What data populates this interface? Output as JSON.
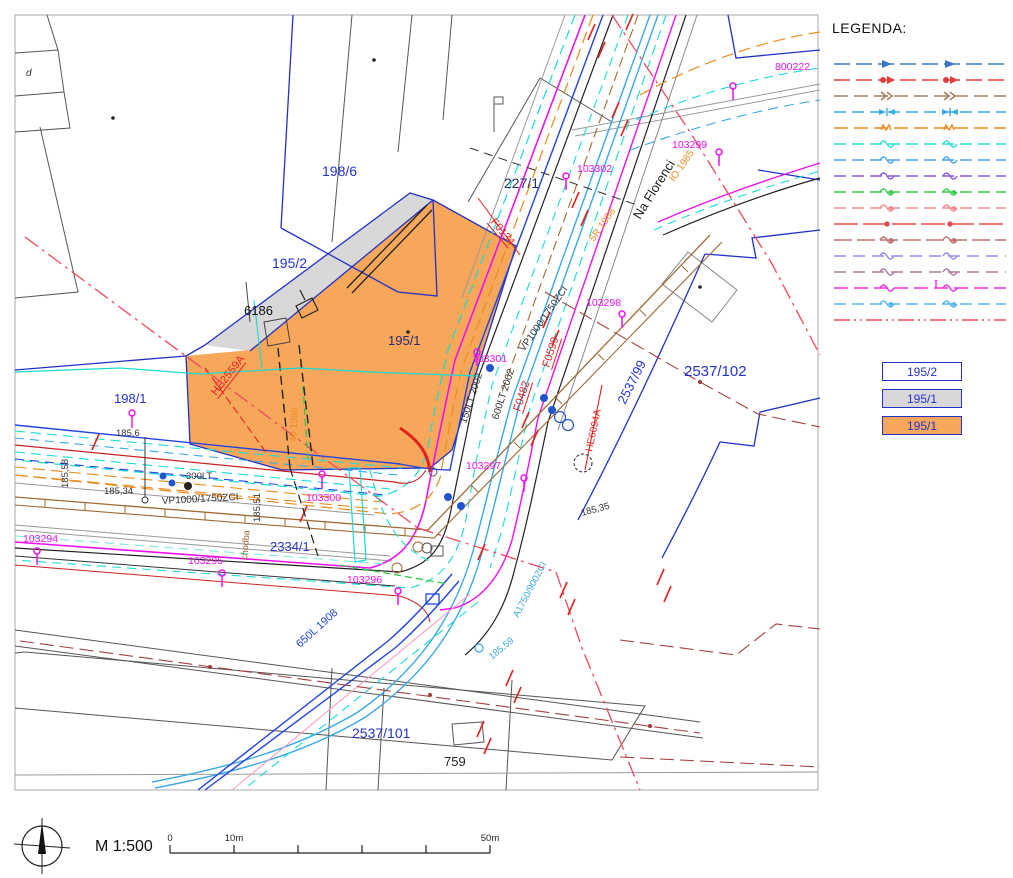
{
  "palette": {
    "parcel_blue": "#2230c8",
    "label_blue": "#2233cc",
    "navy": "#223366",
    "magenta": "#ee11ee",
    "red": "#e22222",
    "orange": "#ea8c1e",
    "cyan": "#17dcd4",
    "skyblue": "#39a8e8",
    "cobalt": "#2244dd",
    "brown": "#a06a32",
    "darkred": "#a4403f",
    "green": "#2ecb44",
    "gray": "#8a8a8a",
    "orange_fill": "#f6a75a",
    "gray_fill": "#d8d8d8",
    "dashdot_red": "#f2485c"
  },
  "legend": {
    "title": "LEGENDA:",
    "lines": [
      {
        "color": "#3b76c8",
        "marker": "arrow",
        "dash": "16 6"
      },
      {
        "color": "#e43b3b",
        "marker": "dotarrow",
        "dash": "16 6"
      },
      {
        "color": "#a5805f",
        "marker": "chevrons",
        "dash": "14 6"
      },
      {
        "color": "#35aaea",
        "marker": "bowtie",
        "dash": "12 6"
      },
      {
        "color": "#ea8c1e",
        "marker": "zigzag",
        "dash": "14 6"
      },
      {
        "color": "#2ae0d4",
        "marker": "sine",
        "dash": "12 6"
      },
      {
        "color": "#4aa3f0",
        "marker": "sine",
        "dash": "12 6"
      },
      {
        "color": "#8a5ae0",
        "marker": "sine",
        "dash": "12 6"
      },
      {
        "color": "#3ecb50",
        "marker": "sinedot",
        "dash": "12 6"
      },
      {
        "color": "#ef8d8d",
        "marker": "sinedot",
        "dash": "12 6"
      },
      {
        "color": "#e84848",
        "marker": "dot",
        "dash": "24 5"
      },
      {
        "color": "#bf7272",
        "marker": "sinedot",
        "dash": "18 5"
      },
      {
        "color": "#9a8ce8",
        "marker": "sine",
        "dash": "12 7"
      },
      {
        "color": "#b27a9a",
        "marker": "sine",
        "dash": "12 7"
      },
      {
        "color": "#ee2ee0",
        "marker": "lollipop",
        "dash": "14 6"
      },
      {
        "color": "#57b8ea",
        "marker": "sinedot",
        "dash": "12 6"
      },
      {
        "color": "#f2485c",
        "marker": "none",
        "dash": "16 4 2 4 2 4"
      }
    ],
    "swatches": [
      {
        "label": "195/2",
        "fill": "#ffffff"
      },
      {
        "label": "195/1",
        "fill": "#d8d8d8"
      },
      {
        "label": "195/1",
        "fill": "#f6a75a"
      }
    ]
  },
  "map": {
    "parcel_labels": [
      {
        "text": "d",
        "x": 26,
        "y": 76,
        "color": "#333",
        "size": 10,
        "italic": true
      },
      {
        "text": "198/6",
        "x": 322,
        "y": 176,
        "color": "#2233cc",
        "size": 14
      },
      {
        "text": "227/1",
        "x": 504,
        "y": 188,
        "color": "#223366",
        "size": 14
      },
      {
        "text": "195/2",
        "x": 272,
        "y": 268,
        "color": "#2233cc",
        "size": 14
      },
      {
        "text": "6186",
        "x": 244,
        "y": 315,
        "color": "#111111",
        "size": 13
      },
      {
        "text": "195/1",
        "x": 388,
        "y": 345,
        "color": "#2a2a70",
        "size": 13
      },
      {
        "text": "198/1",
        "x": 114,
        "y": 403,
        "color": "#2233cc",
        "size": 13
      },
      {
        "text": "2334/1",
        "x": 270,
        "y": 551,
        "color": "#2233cc",
        "size": 13
      },
      {
        "text": "2537/102",
        "x": 684,
        "y": 376,
        "color": "#2233cc",
        "size": 15
      },
      {
        "text": "2537/99",
        "x": 625,
        "y": 405,
        "rot": -63,
        "color": "#2233cc",
        "size": 13
      },
      {
        "text": "2537/101",
        "x": 352,
        "y": 738,
        "color": "#2233cc",
        "size": 14
      },
      {
        "text": "759",
        "x": 444,
        "y": 766,
        "color": "#222222",
        "size": 13
      }
    ],
    "point_labels": [
      {
        "text": "800222",
        "x": 775,
        "y": 70,
        "mx": 733,
        "my": 86
      },
      {
        "text": "103299",
        "x": 672,
        "y": 148,
        "mx": 719,
        "my": 152
      },
      {
        "text": "103302",
        "x": 577,
        "y": 172,
        "mx": 566,
        "my": 176
      },
      {
        "text": "103298",
        "x": 586,
        "y": 306,
        "mx": 622,
        "my": 314
      },
      {
        "text": "103301",
        "x": 472,
        "y": 362,
        "mx": 477,
        "my": 352
      },
      {
        "text": "103297",
        "x": 466,
        "y": 469,
        "mx": 524,
        "my": 478
      },
      {
        "text": "103300",
        "x": 306,
        "y": 501,
        "mx": 322,
        "my": 474
      },
      {
        "text": "103294",
        "x": 23,
        "y": 542,
        "mx": 37,
        "my": 551
      },
      {
        "text": "103295",
        "x": 188,
        "y": 564,
        "mx": 222,
        "my": 573
      },
      {
        "text": "103296",
        "x": 347,
        "y": 583,
        "mx": 398,
        "my": 591
      }
    ],
    "tech_labels": [
      {
        "text": "F0134",
        "x": 490,
        "y": 222,
        "rot": 50,
        "color": "#e22222",
        "size": 11,
        "underline": true
      },
      {
        "text": "F0599",
        "x": 549,
        "y": 368,
        "rot": -72,
        "color": "#e22222",
        "size": 11,
        "underline": true
      },
      {
        "text": "F0482",
        "x": 520,
        "y": 412,
        "rot": -72,
        "color": "#e22222",
        "size": 11,
        "underline": true
      },
      {
        "text": "HE2559A",
        "x": 216,
        "y": 396,
        "rot": -52,
        "color": "#e22222",
        "size": 11,
        "underline": true
      },
      {
        "text": "HE6094A",
        "x": 592,
        "y": 452,
        "rot": -78,
        "color": "#e22222",
        "size": 10
      },
      {
        "text": "Na Florenci",
        "x": 640,
        "y": 220,
        "rot": -58,
        "color": "#222222",
        "size": 13
      },
      {
        "text": "600LT 2002",
        "x": 498,
        "y": 420,
        "rot": -72,
        "color": "#333333",
        "size": 10
      },
      {
        "text": "150LT 2002",
        "x": 466,
        "y": 424,
        "rot": -72,
        "color": "#333333",
        "size": 10
      },
      {
        "text": "VP1000/1750ZCI",
        "x": 524,
        "y": 352,
        "rot": -55,
        "color": "#333333",
        "size": 10
      },
      {
        "text": "VP1000/1750ZCI",
        "x": 162,
        "y": 504,
        "rot": -3,
        "color": "#333333",
        "size": 10
      },
      {
        "text": "300LT",
        "x": 186,
        "y": 479,
        "rot": 0,
        "color": "#333333",
        "size": 9.5
      },
      {
        "text": "185,6",
        "x": 116,
        "y": 436,
        "rot": 0,
        "color": "#333333",
        "size": 9.5
      },
      {
        "text": "185,58",
        "x": 68,
        "y": 488,
        "rot": -90,
        "color": "#333333",
        "size": 9.5
      },
      {
        "text": "185,34",
        "x": 104,
        "y": 494,
        "rot": 0,
        "color": "#333333",
        "size": 9.5
      },
      {
        "text": "185,51",
        "x": 260,
        "y": 522,
        "rot": -90,
        "color": "#333333",
        "size": 9.5
      },
      {
        "text": "185,35",
        "x": 582,
        "y": 516,
        "rot": -15,
        "color": "#333333",
        "size": 9.5
      },
      {
        "text": "185,59",
        "x": 492,
        "y": 660,
        "rot": -40,
        "color": "#39a8e8",
        "size": 9.5
      },
      {
        "text": "A1750/900ZCI",
        "x": 518,
        "y": 618,
        "rot": -62,
        "color": "#39a8e8",
        "size": 9.5
      },
      {
        "text": "650L 1908",
        "x": 300,
        "y": 648,
        "rot": -42,
        "color": "#2244dd",
        "size": 11
      },
      {
        "text": "chodba",
        "x": 247,
        "y": 560,
        "rot": -85,
        "color": "#a15c28",
        "size": 9
      },
      {
        "text": "5R 1988",
        "x": 594,
        "y": 242,
        "rot": -55,
        "color": "#ea8c1e",
        "size": 10
      },
      {
        "text": "IO 1985",
        "x": 674,
        "y": 182,
        "rot": -55,
        "color": "#ea8c1e",
        "size": 10
      },
      {
        "text": "40 1996",
        "x": 296,
        "y": 442,
        "rot": -87,
        "color": "#ea8c1e",
        "size": 9.5
      }
    ]
  },
  "footer": {
    "scale_label": "M 1:500",
    "bar_ticks": [
      {
        "x": 0,
        "label": "0"
      },
      {
        "x": 64,
        "label": "10m"
      },
      {
        "x": 128,
        "label": ""
      },
      {
        "x": 192,
        "label": ""
      },
      {
        "x": 256,
        "label": ""
      },
      {
        "x": 320,
        "label": "50m"
      }
    ]
  }
}
